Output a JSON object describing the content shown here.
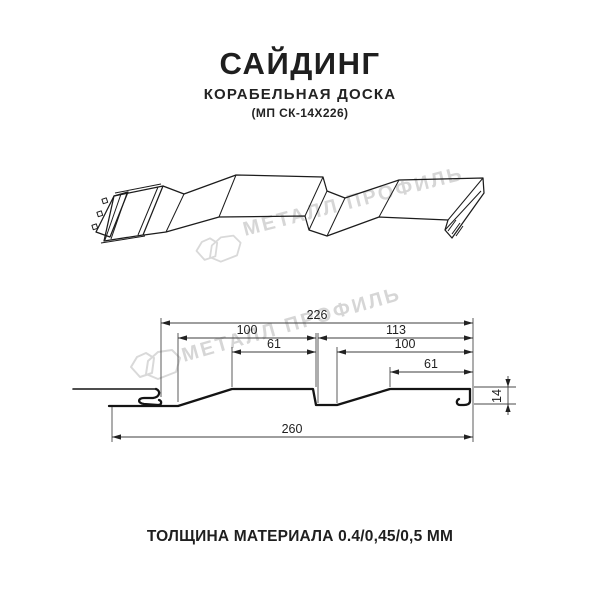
{
  "header": {
    "title": "САЙДИНГ",
    "subtitle": "КОРАБЕЛЬНАЯ ДОСКА",
    "product_code": "(МП СК-14Х226)"
  },
  "watermark": {
    "text": "МЕТАЛЛ ПРОФИЛЬ",
    "color": "#d6d6d6"
  },
  "section": {
    "dimensions": {
      "overall": "226",
      "left_width": "100",
      "right_width": "113",
      "left_flat": "61",
      "right_inner_width": "100",
      "right_flat": "61",
      "total_width": "260",
      "profile_height": "14"
    }
  },
  "footer": {
    "thickness": "ТОЛЩИНА МАТЕРИАЛА 0.4/0,45/0,5 ММ"
  },
  "colors": {
    "background": "#ffffff",
    "text": "#1f1f1f",
    "drawing_line": "#1c1c1c",
    "dimension_line": "#3d3d3d",
    "watermark": "#d6d6d6"
  }
}
